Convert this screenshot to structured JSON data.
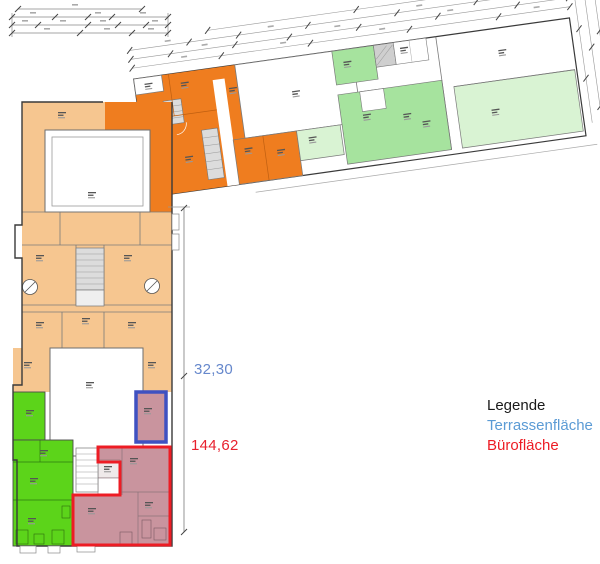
{
  "legend": {
    "title": "Legende",
    "items": [
      {
        "id": "terrace",
        "label": "Terrassenfläche",
        "color": "#5B9BD5"
      },
      {
        "id": "office",
        "label": "Bürofläche",
        "color": "#ED1C24"
      }
    ]
  },
  "measurements": {
    "terrace": {
      "value": "32,30",
      "color": "#6688CC"
    },
    "office": {
      "value": "144,62",
      "color": "#E8202E"
    }
  },
  "palette": {
    "orange": "#EF7D1F",
    "peach": "#F6C690",
    "bright_green": "#5CD41A",
    "medium_green": "#A6E39E",
    "light_green": "#D9F3D3",
    "mauve": "#C9949E",
    "terrace_outline": "#3F51C1",
    "office_outline": "#ED1C24",
    "wall": "#3A3A3A",
    "stair_fill": "#DCDCDC"
  }
}
